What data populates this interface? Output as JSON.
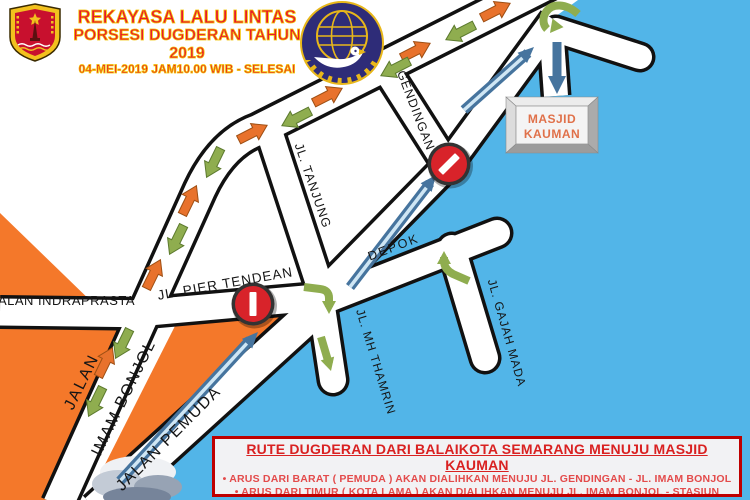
{
  "header": {
    "title_line1": "REKAYASA LALU LINTAS",
    "title_line2": "PORSESI DUGDERAN TAHUN 2019",
    "title_line3": "04-MEI-2019 JAM10.00 WIB - SELESAI",
    "title_color": "#E8192C",
    "title_outline_color": "#F3C400"
  },
  "logos": {
    "left_icon": "semarang-city-crest",
    "right_icon": "kemenhub-transportation-logo"
  },
  "map": {
    "road_labels": {
      "indraprasta": "JALAN INDRAPRASTA",
      "imam_bonjol_line1": "JALAN",
      "imam_bonjol_line2": "IMAM BONJOL",
      "pemuda": "JALAN PEMUDA",
      "pier_tendean": "JL. PIER TENDEAN",
      "tanjung": "JL. TANJUNG",
      "gendingan": "GENDINGAN",
      "depok": "DEPOK",
      "mh_thamrin": "JL. MH THAMRIN",
      "gajah_mada": "JL. GAJAH MADA"
    },
    "destination": {
      "line1": "MASJID",
      "line2": "KAUMAN"
    },
    "icons": [
      "no-entry-sign",
      "flow-arrow-orange",
      "flow-arrow-green",
      "route-arrow-blue"
    ],
    "colors": {
      "sea": "#52B5E8",
      "land": "#F4782A",
      "road": "#FFFFFF",
      "road_casing": "#111111",
      "route_blue": "#46749E",
      "flow_orange": "#E8722C",
      "flow_green": "#8FAD4F",
      "sign_red": "#D8232A"
    }
  },
  "legend": {
    "title": "RUTE DUGDERAN DARI BALAIKOTA SEMARANG MENUJU MASJID KAUMAN",
    "bullets": [
      "•   ARUS DARI BARAT ( PEMUDA ) AKAN DIALIHKAN MENUJU JL. GENDINGAN  -  JL. IMAM BONJOL",
      "•   ARUS DARI TIMUR ( KOTA LAMA ) AKAN DIALIHKAN MENUJU JL. IMAM BONJOL  -  STASIUN PONCOL"
    ]
  }
}
